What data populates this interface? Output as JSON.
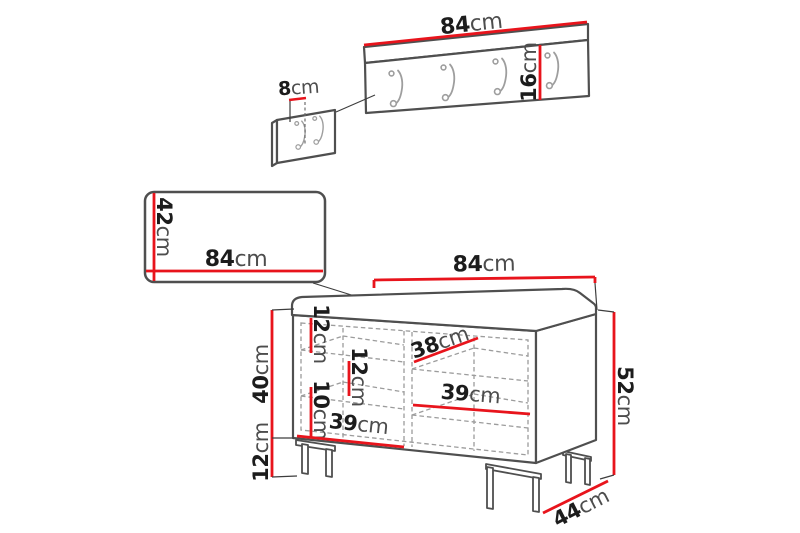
{
  "colors": {
    "dimension_red": "#e8141c",
    "outline_gray": "#4f4f4f",
    "dashed_gray": "#9c9c9c",
    "background": "#ffffff"
  },
  "unit": "cm",
  "labels": {
    "rack_width": {
      "value": "84",
      "unit": "cm"
    },
    "rack_height": {
      "value": "16",
      "unit": "cm"
    },
    "rack_hook_offset": {
      "value": "8",
      "unit": "cm"
    },
    "mirror_height": {
      "value": "42",
      "unit": "cm"
    },
    "mirror_width": {
      "value": "84",
      "unit": "cm"
    },
    "bench_width": {
      "value": "84",
      "unit": "cm"
    },
    "bench_total_height": {
      "value": "52",
      "unit": "cm"
    },
    "bench_depth": {
      "value": "44",
      "unit": "cm"
    },
    "bench_body_height": {
      "value": "40",
      "unit": "cm"
    },
    "bench_leg_height": {
      "value": "12",
      "unit": "cm"
    },
    "shelf_gap_top": {
      "value": "12",
      "unit": "cm"
    },
    "shelf_gap_mid": {
      "value": "12",
      "unit": "cm"
    },
    "shelf_gap_low": {
      "value": "10",
      "unit": "cm"
    },
    "shelf_width_top": {
      "value": "38",
      "unit": "cm"
    },
    "shelf_width_mid": {
      "value": "39",
      "unit": "cm"
    },
    "shelf_width_bottom": {
      "value": "39",
      "unit": "cm"
    }
  }
}
